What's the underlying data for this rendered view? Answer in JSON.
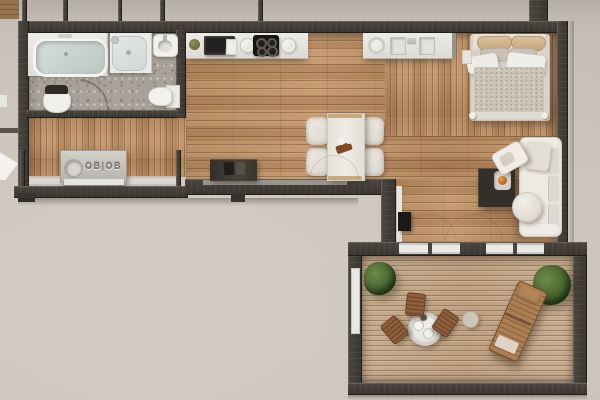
{
  "scene": {
    "title": "Small apartment with balcony — top-down architectural 3D render",
    "view": "top-down floor plan",
    "style": "photorealistic visualization, no UI text"
  },
  "labels": {
    "utility_unit_embossed": "OB|OB"
  },
  "palette": {
    "exterior_ground": "#cbc4ba",
    "wall_dark": "#3f3a34",
    "wood_floor": "#b78b61",
    "balcony_deck": "#c2a385",
    "bathroom_tile": "#a8a29a",
    "fixture_white": "#f1f0ec",
    "furniture_dark": "#332f2b",
    "outdoor_wood": "#8d5e3b",
    "plant_green": "#44632e",
    "pillow_tan": "#d0b287",
    "accent_orange": "#bd6727"
  },
  "rooms": [
    {
      "id": "bathroom",
      "label": "Bathroom",
      "items": [
        "bathtub on platform",
        "walk-in shower",
        "wall basin",
        "toilet",
        "bidet with dark lid",
        "door swing arc"
      ]
    },
    {
      "id": "hallway",
      "label": "Hallway / utility",
      "items": [
        "utility unit with embossed panel and porthole",
        "window band with sill"
      ]
    },
    {
      "id": "kitchen",
      "label": "Kitchen wall",
      "items": [
        "potted plant",
        "microwave oven",
        "plates",
        "4-burner cooktop",
        "double sink with faucet"
      ]
    },
    {
      "id": "dining",
      "label": "Dining area",
      "items": [
        "rectangular white table",
        "4 white chairs",
        "wood-and-flower centerpiece",
        "dark sideboard with books"
      ]
    },
    {
      "id": "bedroom",
      "label": "Sleeping corner",
      "items": [
        "double bed",
        "2 tan pillows",
        "2 grey pillows",
        "white duvet folds",
        "textured blanket",
        "nightstand"
      ]
    },
    {
      "id": "living",
      "label": "Living corner",
      "items": [
        "white sofa",
        "chaise cushion",
        "round pouf",
        "dark coffee table with bowl",
        "sliding glass doors",
        "black media box"
      ]
    },
    {
      "id": "balcony",
      "label": "Balcony terrace",
      "items": [
        "round bistro table with cups",
        "3 brown folding chairs",
        "sun lounger",
        "round side table",
        "2 potted plants"
      ]
    }
  ]
}
